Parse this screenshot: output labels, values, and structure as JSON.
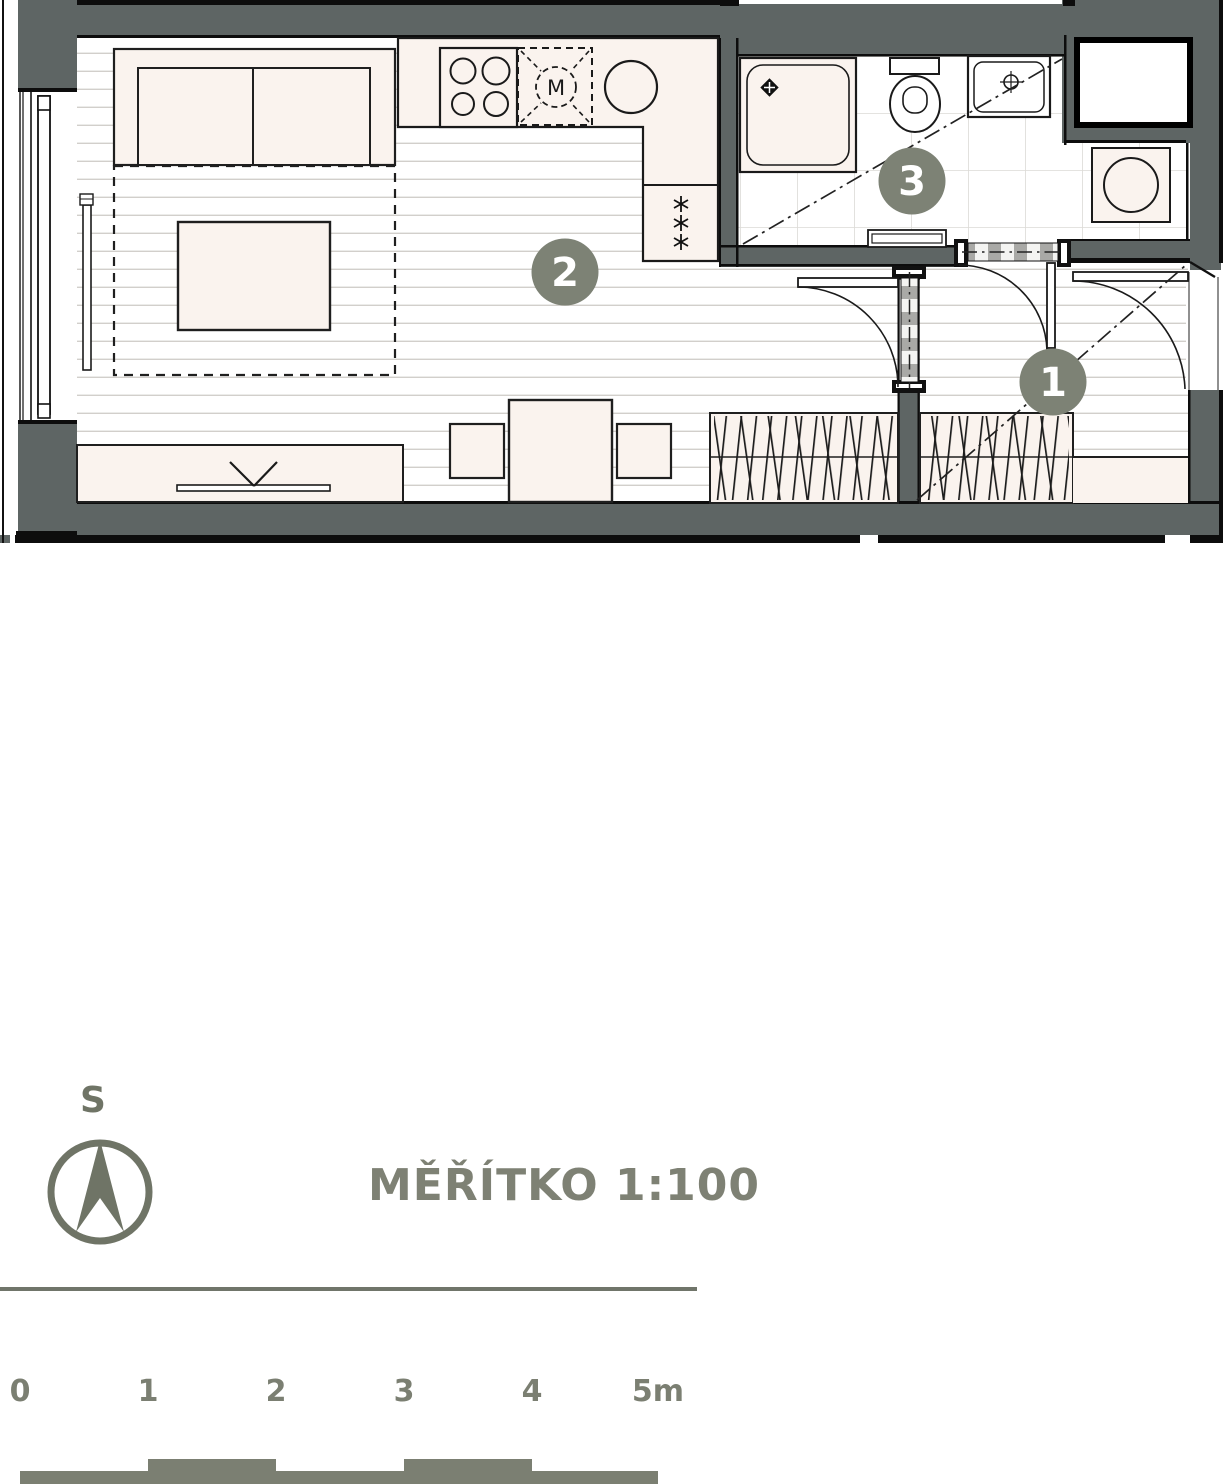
{
  "scale_note": {
    "title": "MĚŘÍTKO 1:100"
  },
  "compass": {
    "north_label": "S"
  },
  "scale_bar": {
    "ticks": [
      "0",
      "1",
      "2",
      "3",
      "4",
      "5m"
    ]
  },
  "plan": {
    "markers": [
      {
        "number": "1",
        "room": "entrance-hall"
      },
      {
        "number": "2",
        "room": "living-room-with-kitchen"
      },
      {
        "number": "3",
        "room": "bathroom"
      }
    ],
    "kitchen": {
      "microwave_label": "M",
      "freezer_icon": "snowflake-stars"
    },
    "colors": {
      "wall": "#5e6564",
      "marker": "#7d8275",
      "annotation": "#7b7f72",
      "furniture_fill": "#faf3ee",
      "floor_line": "#d2cfcb"
    }
  }
}
